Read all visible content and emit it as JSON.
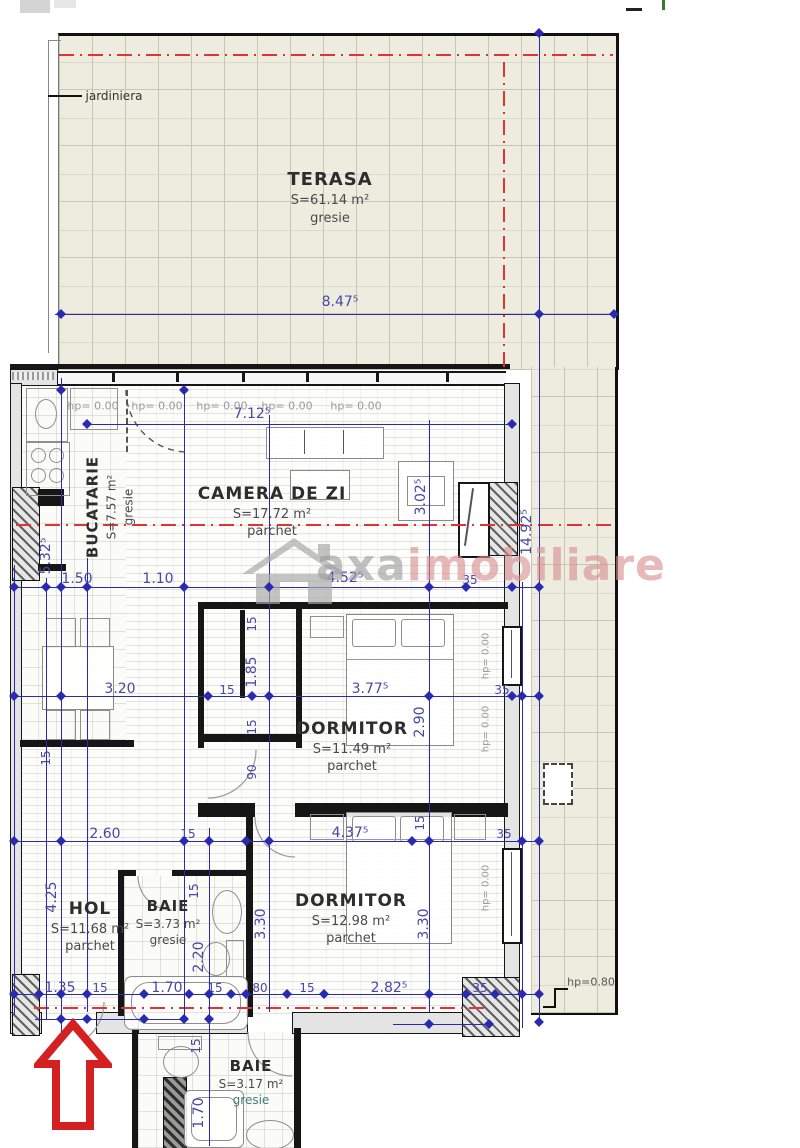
{
  "rooms": {
    "terasa": {
      "name": "TERASA",
      "area": "S=61.14 m²",
      "floor": "gresie"
    },
    "bucatarie": {
      "name": "BUCATARIE",
      "area": "S=7.57 m²",
      "floor": "gresie"
    },
    "camera_de_zi": {
      "name": "CAMERA DE ZI",
      "area": "S=17.72 m²",
      "floor": "parchet"
    },
    "dormitor1": {
      "name": "DORMITOR",
      "area": "S=11.49 m²",
      "floor": "parchet"
    },
    "dormitor2": {
      "name": "DORMITOR",
      "area": "S=12.98 m²",
      "floor": "parchet"
    },
    "hol": {
      "name": "HOL",
      "area": "S=11.68 m²",
      "floor": "parchet"
    },
    "baie1": {
      "name": "BAIE",
      "area": "S=3.73 m²",
      "floor": "gresie"
    },
    "baie2": {
      "name": "BAIE",
      "area": "S=3.17 m²",
      "floor": "gresie"
    }
  },
  "labels": {
    "jardiniera": "jardiniera",
    "hp_zero": "hp= 0.00",
    "hp_080": "hp=0.80"
  },
  "watermark": {
    "part1": "axa",
    "part2": "imobiliare"
  },
  "dims": {
    "d847": "8.47⁵",
    "d712": "7.12⁵",
    "d532": "5.32⁵",
    "d150": "1.50",
    "d110": "1.10",
    "d452": "4.52⁵",
    "d302": "3.02⁵",
    "d1492": "14.92⁵",
    "d320": "3.20",
    "d185": "1.85",
    "d377": "3.77⁵",
    "d290": "2.90",
    "d90": "90",
    "d35": "35",
    "d15": "15",
    "d260": "2.60",
    "d437": "4.37⁵",
    "d425": "4.25",
    "d330": "3.30",
    "d220": "2.20",
    "d135": "1.35",
    "d170": "1.70",
    "d80": "80",
    "d282": "2.82⁵"
  },
  "colors": {
    "dimension": "#2a2ab0",
    "centerline": "#e03434",
    "wall": "#161616",
    "tile": "#edecdf",
    "watermark_pink": "#d98f8f",
    "arrow": "#d42020"
  }
}
